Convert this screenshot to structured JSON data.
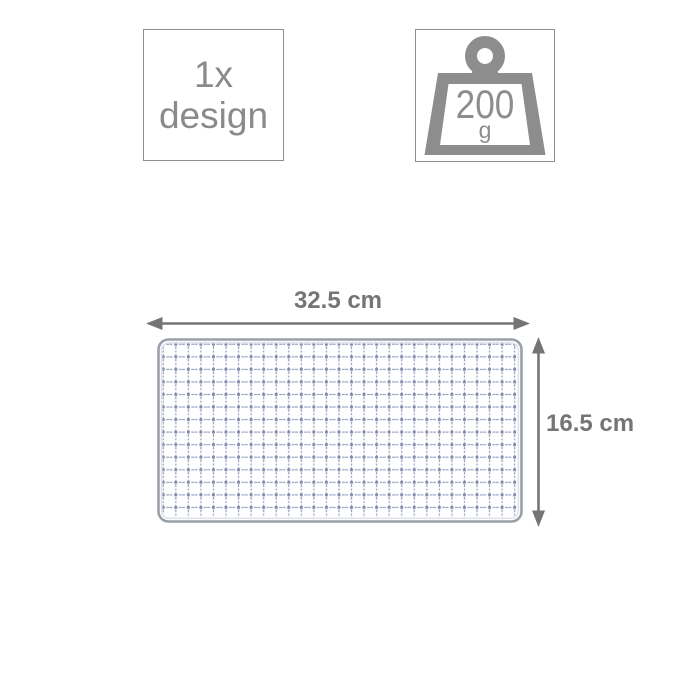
{
  "design_badge": {
    "quantity": "1x",
    "label": "design"
  },
  "weight_badge": {
    "value": "200",
    "unit": "g"
  },
  "dimensions": {
    "width_label": "32.5 cm",
    "height_label": "16.5 cm"
  },
  "colors": {
    "badge_text_gray": "#8a8a8a",
    "badge_border_gray": "#8f8f8f",
    "icon_gray": "#8d8d8d",
    "dimension_text_gray": "#757575",
    "arrow_gray": "#747474",
    "mesh_wire_blue_gray": "#9aa1c2",
    "mesh_knot_gray": "#8289a9",
    "mesh_frame_gray": "#99a0aa",
    "background": "#ffffff"
  }
}
